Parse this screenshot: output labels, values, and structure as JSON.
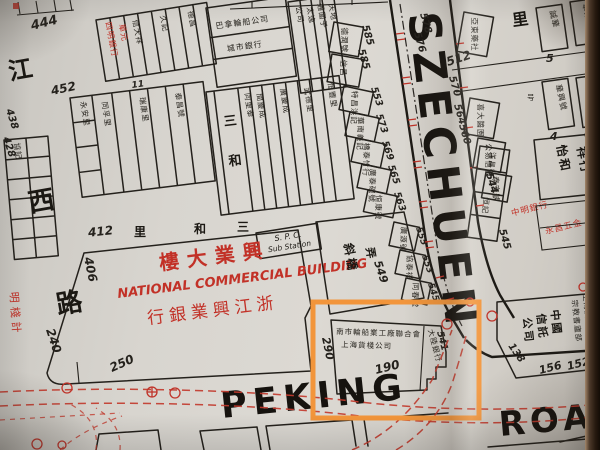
{
  "photo": {
    "paper_color": "#d8d5cf",
    "book_edge_color": "#26190f"
  },
  "annotation": {
    "highlight_color": "#f2953b"
  },
  "roads": {
    "szechuen": "SZECHUEN",
    "peking": "PEKING",
    "road": "ROAD",
    "kiangse_vertical": [
      "江",
      "西",
      "路"
    ],
    "sanho_street_rtl": [
      "里",
      "和",
      "三"
    ],
    "sanho_lane_vertical": [
      "三",
      "和"
    ]
  },
  "landmark": {
    "building_cn_rtl": "樓大業興",
    "building_en": "NATIONAL COMMERCIAL BUILDING",
    "bank_cn_rtl": "行銀業興江浙"
  },
  "spc": {
    "line1": "S. P. C.",
    "line2": "Sub Station"
  },
  "numbers": {
    "n444": "444",
    "n452": "452",
    "n438": "438",
    "n428": "428",
    "n412": "412",
    "n406": "406",
    "n240": "240",
    "n250": "250",
    "n290": "290",
    "n190": "190",
    "n11": "11",
    "n512": "512",
    "n578": "578",
    "n576": "576",
    "n570": "570",
    "n564": "564",
    "n560": "560",
    "e585a": "585",
    "e585b": "585",
    "e553": "553",
    "e573": "573",
    "e569": "569",
    "e565": "565",
    "e563": "563",
    "n549": "549",
    "n555": "555",
    "s553": "553",
    "n545": "545",
    "n541": "541",
    "n544": "544",
    "n545b": "545",
    "n138": "138",
    "n156": "156",
    "n152": "152",
    "n5": "5",
    "n7": "7",
    "n4": "4",
    "n6": "6"
  },
  "shops": {
    "red_top": [
      "四明銀行",
      "單元"
    ],
    "top_row": [
      "巴拿輪船公司",
      "城市銀行"
    ],
    "top_strips": [
      "公司",
      "太逸",
      "通圍子",
      "天地"
    ],
    "b444": [
      "信大祥",
      "久記",
      "德昌"
    ],
    "b452": [
      "同孚里",
      "瑞康里",
      "泰昌號"
    ],
    "left_edge": [
      "永安里",
      "協記"
    ],
    "sanho": [
      "同里泰",
      "間慶成",
      "廣慶成",
      "武德里",
      "恒豐里"
    ],
    "west": [
      "德潤號",
      "信昌",
      "特昌洪記",
      "華南義記",
      "橋泰竹行",
      "廣泰碗號",
      "恒康號"
    ],
    "xieqiao": [
      "斜橋",
      "弄"
    ],
    "xieqiao_east": [
      "廣源號",
      "協泰祥",
      "同春堂"
    ],
    "corner_row1": "南市輪船業工廠聯合會",
    "corner_row2": "上海貨棧公司",
    "corner_end": "大陸銀行",
    "east_top": [
      "亞東藥社",
      "喜大醬園",
      "公易信記",
      "泰安號"
    ],
    "ne": {
      "li": "里",
      "chenghua": "誠華",
      "huadong": "華東公司",
      "huaxing": "華興號",
      "zhongxin": "忠信行",
      "hao": "号"
    },
    "yiho": [
      "怡和",
      "祥行"
    ],
    "mid_right": [
      "洋昌號",
      "恒記"
    ],
    "red_mid": [
      "中明銀行",
      "永昌五金"
    ],
    "trust_rtl": [
      "中國",
      "信託",
      "公司"
    ],
    "books": [
      "宗教書廬部",
      "上海廣益書局"
    ],
    "red_left": "明棧計"
  }
}
